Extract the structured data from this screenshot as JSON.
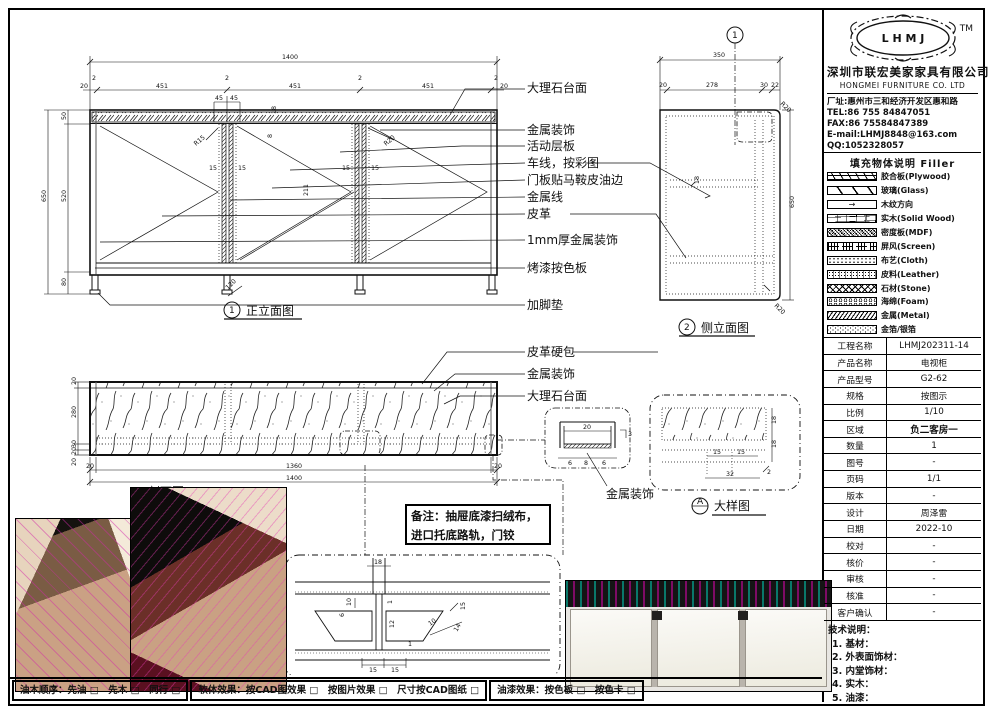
{
  "company": {
    "logo": "L H M J",
    "tm": "TM",
    "name_cn": "深圳市联宏美家家具有限公司",
    "name_en": "HONGMEI FURNITURE CO. LTD",
    "address": "厂址:惠州市三和经济开发区惠和路",
    "tel": "TEL:86 755 84847051",
    "fax": "FAX:86 75584847389",
    "email": "E-mail:LHMJ8848@163.com",
    "qq": "QQ:1052328057"
  },
  "legend": {
    "title": "填充物体说明  Filler",
    "items": [
      {
        "label": "胶合板(Plywood)"
      },
      {
        "label": "玻璃(Glass)"
      },
      {
        "label": "木纹方向"
      },
      {
        "label": "实木(Solid Wood)"
      },
      {
        "label": "密度板(MDF)"
      },
      {
        "label": "屏风(Screen)"
      },
      {
        "label": "布艺(Cloth)"
      },
      {
        "label": "皮料(Leather)"
      },
      {
        "label": "石材(Stone)"
      },
      {
        "label": "海绵(Foam)"
      },
      {
        "label": "金属(Metal)"
      },
      {
        "label": "金箔/银箔"
      }
    ]
  },
  "info": {
    "rows": [
      {
        "label": "工程名称",
        "value": "LHMJ202311-14"
      },
      {
        "label": "产品名称",
        "value": "电视柜"
      },
      {
        "label": "产品型号",
        "value": "G2-62"
      },
      {
        "label": "规格",
        "value": "按图示"
      },
      {
        "label": "比例",
        "value": "1/10"
      },
      {
        "label": "区域",
        "value": "负二客房一"
      },
      {
        "label": "数量",
        "value": "1"
      },
      {
        "label": "图号",
        "value": "-"
      },
      {
        "label": "页码",
        "value": "1/1"
      },
      {
        "label": "版本",
        "value": "-"
      },
      {
        "label": "设计",
        "value": "周泽雷"
      },
      {
        "label": "日期",
        "value": "2022-10"
      },
      {
        "label": "校对",
        "value": "-"
      },
      {
        "label": "核价",
        "value": "-"
      },
      {
        "label": "审核",
        "value": "-"
      },
      {
        "label": "核准",
        "value": "-"
      },
      {
        "label": "客户确认",
        "value": "-"
      }
    ]
  },
  "tech": {
    "title": "技术说明：",
    "items": [
      "1. 基材：",
      "2. 外表面饰材：",
      "3. 内堂饰材：",
      "4. 实木：",
      "5. 油漆："
    ]
  },
  "note": {
    "line1": "备注：抽屉底漆扫绒布，",
    "line2": "进口托底路轨，门铰"
  },
  "footer": {
    "seg1": "油木顺序：先油 □　先木 □　同行 □",
    "seg2": "软体效果：按CAD图效果 □　按图片效果 □　尺寸按CAD图纸 □",
    "seg3": "油漆效果：按色板 □　按色卡 □"
  },
  "views": {
    "front": {
      "num": "1",
      "title": "正立面图",
      "labels": [
        "大理石台面",
        "金属装饰",
        "活动层板",
        "车线，按彩图",
        "门板贴马鞍皮油边",
        "金属线",
        "皮革",
        "1mm厚金属装饰",
        "烤漆按色板",
        "加脚垫"
      ],
      "dims": {
        "w": "1400",
        "seg": "451",
        "gap": "2",
        "end": "20",
        "c45": "45",
        "h": "650",
        "h1": "50",
        "h2": "520",
        "h3": "80",
        "v211": "211",
        "r15": "R15",
        "r20": "R20",
        "d15": "15",
        "d18": "18",
        "d8": "8",
        "d120": "120"
      }
    },
    "side": {
      "num": "2",
      "title": "侧立面图",
      "cut_num": "1",
      "dims": {
        "w": "350",
        "c1": "20",
        "c2": "278",
        "c3": "30",
        "c4": "22",
        "h": "650",
        "r20": "R20",
        "d18": "18"
      }
    },
    "section": {
      "title": "剖面图",
      "labels": [
        "皮革硬包",
        "金属装饰",
        "大理石台面"
      ],
      "dims": {
        "l1": "20",
        "l2": "280",
        "l3": "30",
        "l4": "20",
        "l5": "20",
        "b1": "20",
        "b2": "1360",
        "b3": "20",
        "w": "1400"
      }
    },
    "detail_a": {
      "num": "A",
      "title": "大样图",
      "dims": {
        "d15a": "15",
        "d15b": "15",
        "d32": "32",
        "d18a": "18",
        "d18b": "18",
        "d2": "2"
      }
    },
    "joint": {
      "dims": {
        "d18": "18",
        "d10": "10",
        "d6": "6",
        "d1a": "1",
        "d12": "12",
        "d15": "15",
        "d14": "14",
        "d10b": "10",
        "d1b": "1",
        "b15a": "15",
        "b15b": "15"
      }
    },
    "metal": {
      "label": "金属装饰",
      "dims": {
        "d20": "20",
        "d6a": "6",
        "d8": "8",
        "d6b": "6",
        "d3": "3"
      }
    }
  }
}
